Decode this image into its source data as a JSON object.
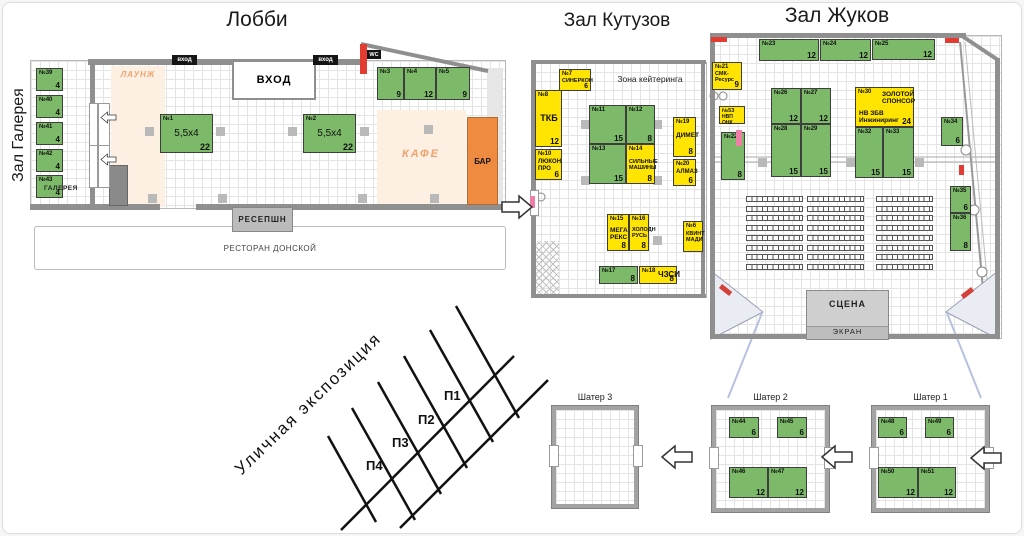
{
  "titles": {
    "lobby": "Лобби",
    "gallery": "Зал Галерея",
    "kutuzov": "Зал Кутузов",
    "zhukov": "Зал Жуков"
  },
  "lobby": {
    "entrance": "ВХОД",
    "entrance_small": "вход",
    "wc": "WC",
    "lounge": "ЛАУНЖ",
    "cafe": "КАФЕ",
    "bar": "БАР",
    "reception": "РЕСЕПШН",
    "restaurant": "РЕСТОРАН ДОНСКОЙ",
    "gallery_label": "ГАЛЕРЕЯ"
  },
  "kutuzov": {
    "catering_zone": "Зона кейтеринга"
  },
  "zhukov": {
    "stage": "СЦЕНА",
    "screen": "ЭКРАН"
  },
  "street": {
    "title": "Уличная экспозиция",
    "plots": [
      "П1",
      "П2",
      "П3",
      "П4"
    ]
  },
  "tents": {
    "t3": "Шатер 3",
    "t2": "Шатер 2",
    "t1": "Шатер 1"
  },
  "colors": {
    "stand_green": "#7cb968",
    "stand_yellow": "#ffe301",
    "bar_orange": "#ef8b40",
    "zone_peach": "#fdf0e2",
    "wall_gray": "#8f8f8f",
    "red_marker": "#e23c32"
  },
  "stands": {
    "s1": {
      "n": "№1",
      "sz": "5,5x4",
      "ar": "22"
    },
    "s2": {
      "n": "№2",
      "sz": "5,5x4",
      "ar": "22"
    },
    "s3": {
      "n": "№3",
      "ar": "9"
    },
    "s4": {
      "n": "№4",
      "ar": "12"
    },
    "s5": {
      "n": "№5",
      "ar": "9"
    },
    "s39": {
      "n": "№39",
      "ar": "4"
    },
    "s40": {
      "n": "№40",
      "ar": "4"
    },
    "s41": {
      "n": "№41",
      "ar": "4"
    },
    "s42": {
      "n": "№42",
      "ar": "4"
    },
    "s43": {
      "n": "№43",
      "ar": "4"
    },
    "s6": {
      "n": "№6",
      "co": "КВИНТ МАДИ"
    },
    "s7": {
      "n": "№7",
      "co": "СИНЕРКОН",
      "ar": "6"
    },
    "s8": {
      "n": "№8",
      "co": "ТКБ",
      "ar": "12"
    },
    "s10": {
      "n": "№10",
      "co": "ЛЮКОН ПРО",
      "ar": "6"
    },
    "s11": {
      "n": "№11",
      "ar": "15"
    },
    "s12": {
      "n": "№12",
      "ar": "8"
    },
    "s13": {
      "n": "№13",
      "ar": "15"
    },
    "s14": {
      "n": "№14",
      "co": "СИЛЬНЫЕ МАШИНЫ",
      "ar": "8"
    },
    "s15": {
      "n": "№15",
      "co": "МЕГА РЕКС",
      "ar": "8"
    },
    "s16": {
      "n": "№16",
      "co": "ХОЛОДН РУСЬ",
      "ar": "8"
    },
    "s17": {
      "n": "№17",
      "ar": "8"
    },
    "s18": {
      "n": "№18",
      "co": "ЧЗСИ",
      "ar": "8"
    },
    "s19": {
      "n": "№19",
      "co": "ДИМЕТ",
      "ar": "8"
    },
    "s20": {
      "n": "№20",
      "co": "АЛМАЗ",
      "ar": "6"
    },
    "s21": {
      "n": "№21",
      "co": "СМК-Ресурс",
      "ar": "9"
    },
    "s22": {
      "n": "№22",
      "ar": "8"
    },
    "s23": {
      "n": "№23",
      "ar": "12"
    },
    "s24": {
      "n": "№24",
      "ar": "12"
    },
    "s25": {
      "n": "№25",
      "ar": "12"
    },
    "s26": {
      "n": "№26",
      "ar": "12"
    },
    "s27": {
      "n": "№27",
      "ar": "12"
    },
    "s28": {
      "n": "№28",
      "ar": "15"
    },
    "s29": {
      "n": "№29",
      "ar": "15"
    },
    "s30": {
      "n": "№30",
      "co": "ЗОЛОТОЙ СПОНСОР",
      "co2": "НВ ЗБВ Инжиниринг",
      "ar": "24"
    },
    "s32": {
      "n": "№32",
      "ar": "15"
    },
    "s33": {
      "n": "№33",
      "ar": "15"
    },
    "s34": {
      "n": "№34",
      "ar": "6"
    },
    "s35": {
      "n": "№35",
      "ar": "6"
    },
    "s36": {
      "n": "№36",
      "ar": "8"
    },
    "s53": {
      "n": "№53",
      "co": "НВП ОНК"
    },
    "s44": {
      "n": "№44",
      "ar": "6"
    },
    "s45": {
      "n": "№45",
      "ar": "6"
    },
    "s46": {
      "n": "№46",
      "ar": "12"
    },
    "s47": {
      "n": "№47",
      "ar": "12"
    },
    "s48": {
      "n": "№48",
      "ar": "6"
    },
    "s49": {
      "n": "№49",
      "ar": "6"
    },
    "s50": {
      "n": "№50",
      "ar": "12"
    },
    "s51": {
      "n": "№51",
      "ar": "12"
    }
  }
}
